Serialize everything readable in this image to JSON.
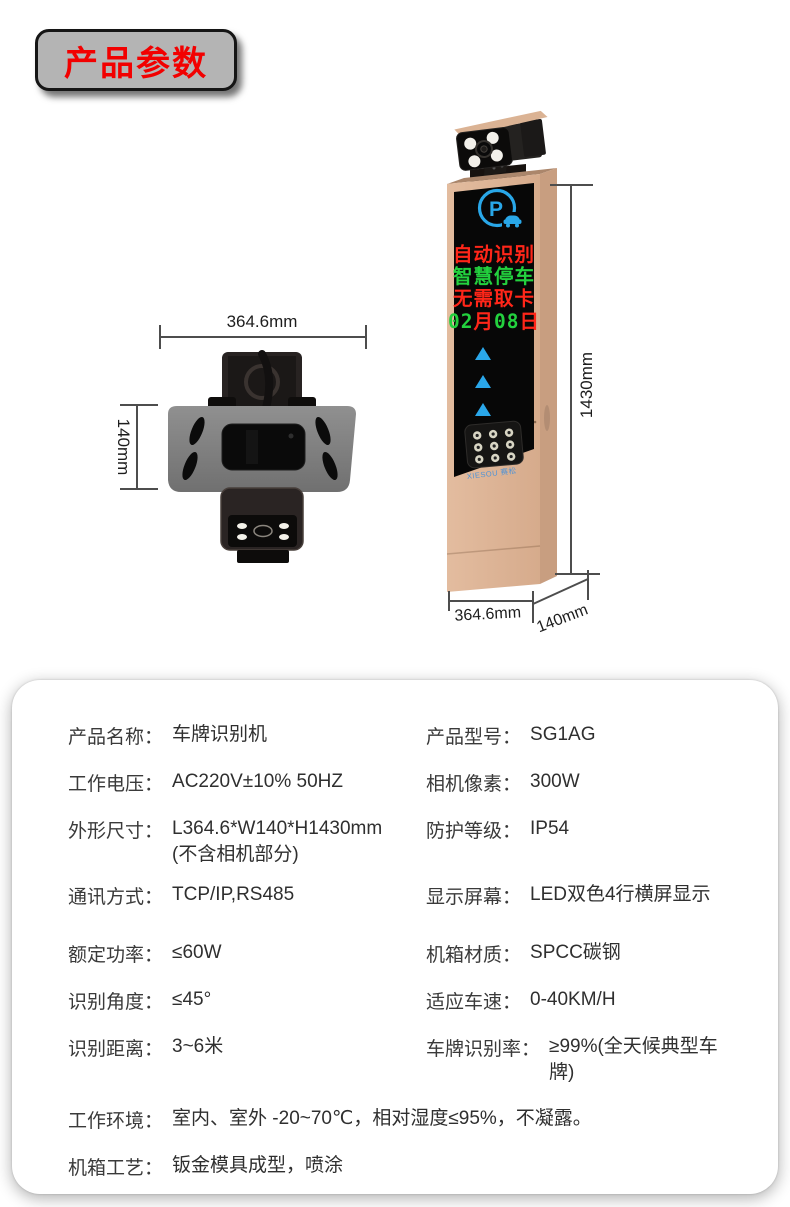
{
  "badge": {
    "label": "产品参数"
  },
  "colors": {
    "badge_red": "#f20000",
    "badge_gray": "#b4b4b4",
    "tower_gold": "#ddb597",
    "tower_gold_side": "#c89e80",
    "accent_blue": "#29a7e8",
    "led_red": "#ff2619",
    "led_green": "#23d13e"
  },
  "top_view": {
    "width_dim": "364.6mm",
    "height_dim": "140mm"
  },
  "front_view": {
    "height_dim": "1430mm",
    "width_dim": "364.6mm",
    "depth_dim": "140mm",
    "logo_letter": "P",
    "brand": "XIESOU 赛松",
    "led_lines": [
      {
        "text": "自动识别",
        "color": "#ff2619"
      },
      {
        "text": "智慧停车",
        "color": "#23d13e"
      },
      {
        "text": "无需取卡",
        "color": "#ff2619"
      },
      {
        "segments": [
          {
            "text": "02",
            "color": "#23d13e"
          },
          {
            "text": "月",
            "color": "#ff2619"
          },
          {
            "text": "08",
            "color": "#23d13e"
          },
          {
            "text": "日",
            "color": "#ff2619"
          }
        ]
      }
    ]
  },
  "specs": {
    "left": [
      {
        "label": "产品名称：",
        "value": "车牌识别机"
      },
      {
        "label": "工作电压：",
        "value": "AC220V±10% 50HZ"
      },
      {
        "label": "外形尺寸：",
        "value": "L364.6*W140*H1430mm",
        "value2": "(不含相机部分)"
      },
      {
        "label": "通讯方式：",
        "value": "TCP/IP,RS485"
      },
      {
        "label": "额定功率：",
        "value": "≤60W"
      },
      {
        "label": "识别角度：",
        "value": "≤45°"
      },
      {
        "label": "识别距离：",
        "value": "3~6米"
      }
    ],
    "right": [
      {
        "label": "产品型号：",
        "value": "SG1AG"
      },
      {
        "label": "相机像素：",
        "value": "300W"
      },
      {
        "label": "防护等级：",
        "value": "IP54"
      },
      {
        "label": "显示屏幕：",
        "value": "LED双色4行横屏显示"
      },
      {
        "label": "机箱材质：",
        "value": "SPCC碳钢"
      },
      {
        "label": "适应车速：",
        "value": "0-40KM/H"
      },
      {
        "label": "车牌识别率：",
        "value": "≥99%(全天候典型车牌)"
      }
    ],
    "full": [
      {
        "label": "工作环境：",
        "value": "室内、室外 -20~70℃，相对湿度≤95%，不凝露。"
      },
      {
        "label": "机箱工艺：",
        "value": "钣金模具成型，喷涂"
      }
    ]
  }
}
